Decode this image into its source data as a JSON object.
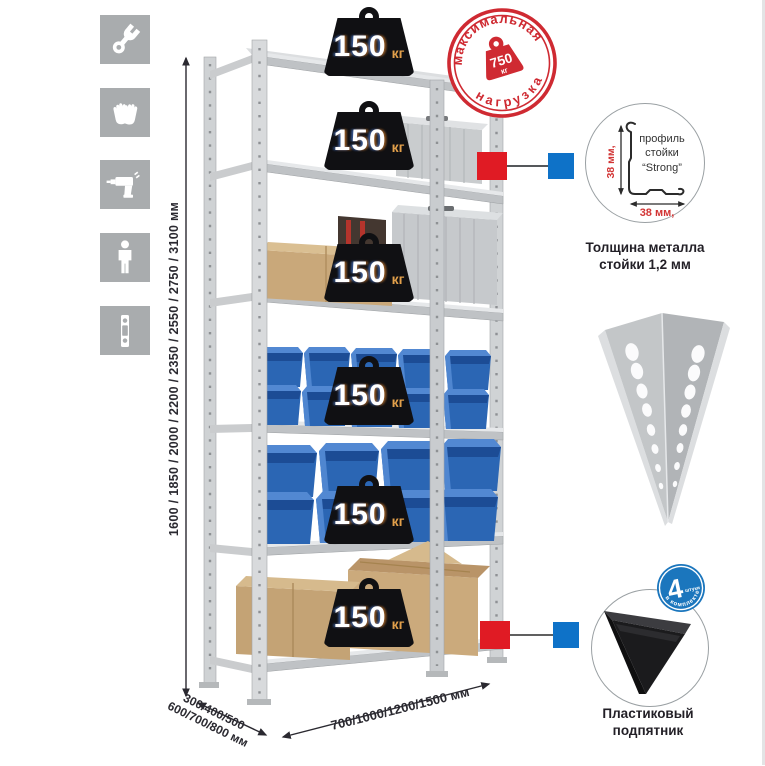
{
  "colors": {
    "accent_red": "#d92b31",
    "accent_blue": "#0e72c8",
    "tile_gray": "#a9acae",
    "bin_blue": "#2b66b4",
    "badge_black": "#101013",
    "badge_unit_orange": "#e2a04b"
  },
  "sidebar": {
    "icons": [
      {
        "name": "wrench-icon"
      },
      {
        "name": "gloves-icon"
      },
      {
        "name": "drill-icon"
      },
      {
        "name": "person-icon"
      },
      {
        "name": "post-strip-icon"
      }
    ]
  },
  "rack": {
    "shelves": [
      {
        "load": "150",
        "unit": "кг"
      },
      {
        "load": "150",
        "unit": "кг"
      },
      {
        "load": "150",
        "unit": "кг"
      },
      {
        "load": "150",
        "unit": "кг"
      },
      {
        "load": "150",
        "unit": "кг"
      },
      {
        "load": "150",
        "unit": "кг"
      }
    ]
  },
  "stamp": {
    "arc_top": "максимальная",
    "arc_bottom": "нагрузка",
    "value": "750",
    "unit": "кг"
  },
  "dimensions": {
    "height": "1600 / 1850 / 2000 / 2200 / 2350 / 2550 / 2750 / 3100 мм",
    "depth_line1": "300/400/500",
    "depth_line2": "600/700/800 мм",
    "width": "700/1000/1200/1500 мм"
  },
  "profile_detail": {
    "label_line1": "профиль",
    "label_line2": "стойки",
    "label_line3": "“Strong”",
    "dim_vertical": "38 мм,",
    "dim_horizontal": "38 мм,",
    "caption_line1": "Толщина металла",
    "caption_line2": "стойки 1,2 мм"
  },
  "foot_detail": {
    "count": "4",
    "count_note": "штуки",
    "arc_text": "в комплекте",
    "caption_line1": "Пластиковый",
    "caption_line2": "подпятник"
  }
}
